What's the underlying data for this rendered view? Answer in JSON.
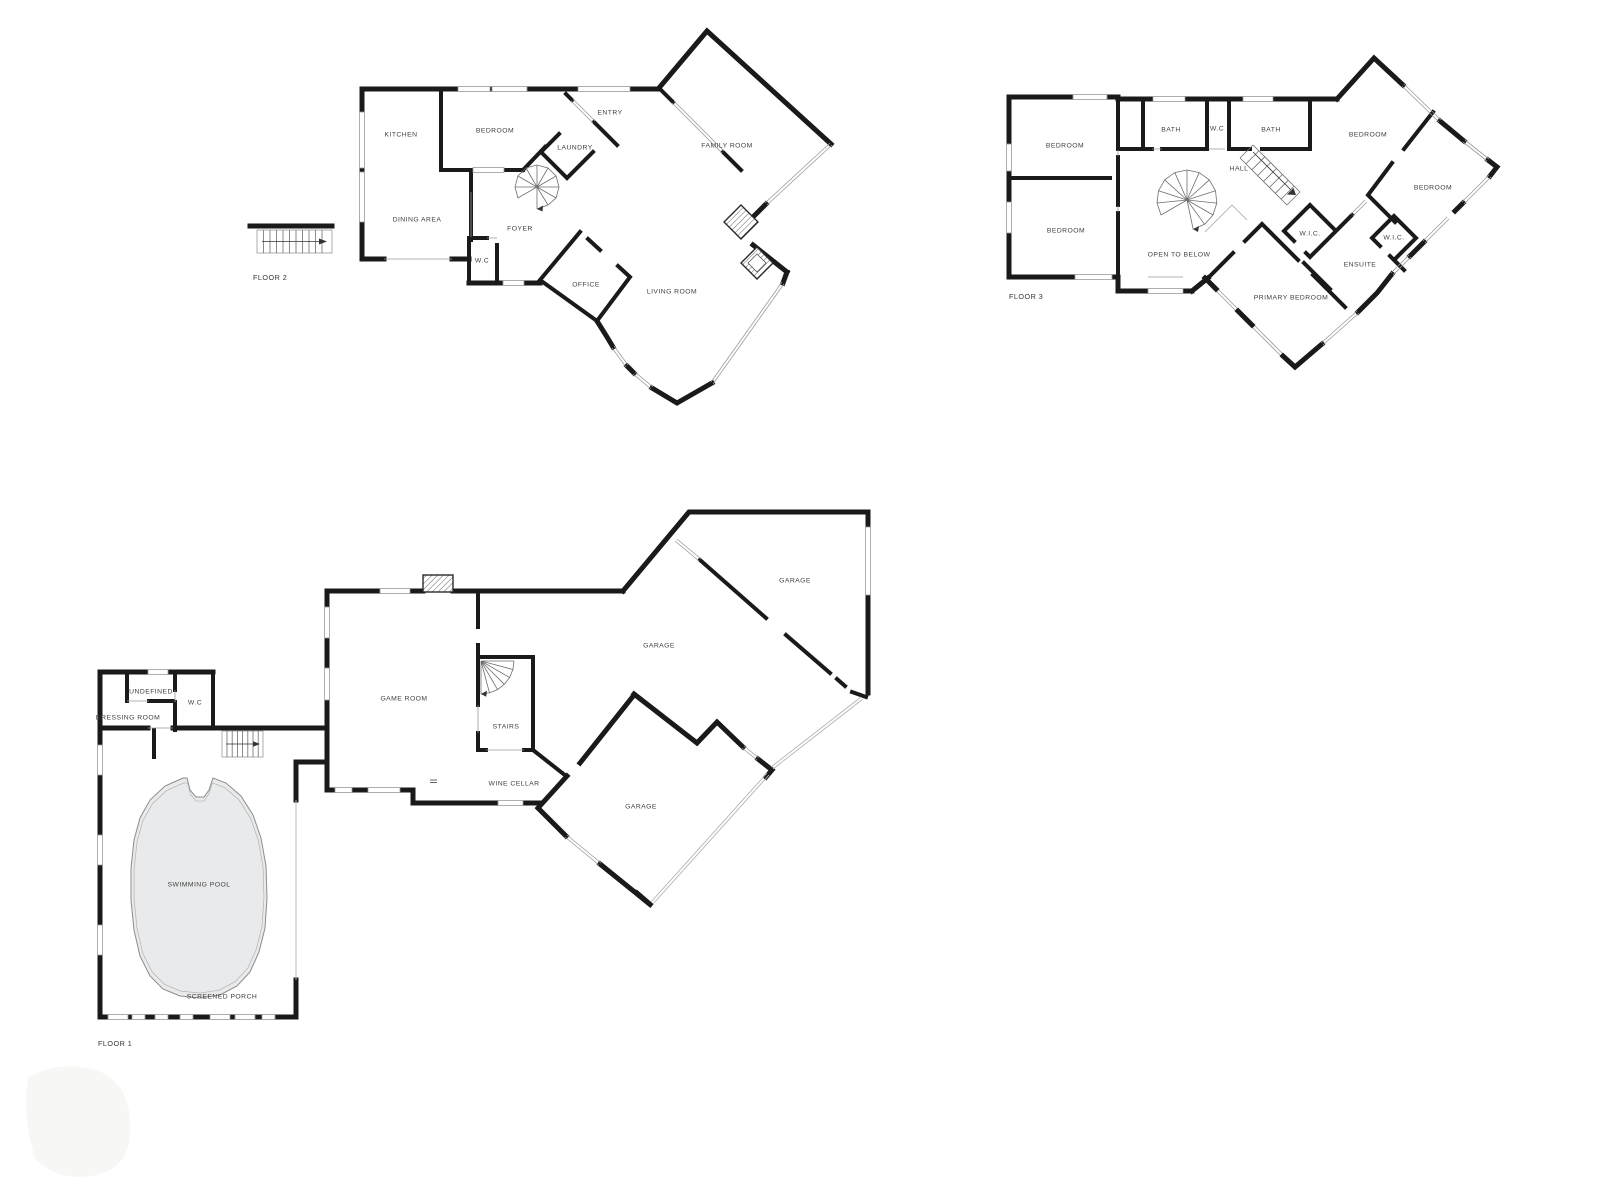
{
  "colors": {
    "ink": "#1a1a1a",
    "win": "#9a9a9a",
    "pool": "#e9eaeb",
    "label": "#3f3f3f",
    "bg": "#ffffff"
  },
  "floor2": {
    "label": "FLOOR 2",
    "rooms": {
      "kitchen": "KITCHEN",
      "bedroom": "BEDROOM",
      "entry": "ENTRY",
      "laundry": "LAUNDRY",
      "family_room": "FAMILY ROOM",
      "dining_area": "DINING AREA",
      "foyer": "FOYER",
      "wc": "W.C",
      "office": "OFFICE",
      "living_room": "LIVING ROOM"
    }
  },
  "floor3": {
    "label": "FLOOR 3",
    "rooms": {
      "bedroom_nw": "BEDROOM",
      "bath_left": "BATH",
      "wc": "W.C",
      "bath_right": "BATH",
      "bedroom_ne": "BEDROOM",
      "hall": "HALL",
      "bedroom_e": "BEDROOM",
      "bedroom_sw": "BEDROOM",
      "open_to_below": "OPEN TO BELOW",
      "wic_left": "W.I.C.",
      "wic_right": "W.I.C.",
      "ensuite": "ENSUITE",
      "primary_bedroom": "PRIMARY BEDROOM"
    }
  },
  "floor1": {
    "label": "FLOOR 1",
    "rooms": {
      "undefined_room": "UNDEFINED",
      "wc": "W.C",
      "dressing_room": "DRESSING ROOM",
      "game_room": "GAME ROOM",
      "stairs": "STAIRS",
      "wine_cellar": "WINE CELLAR",
      "garage_ne": "GARAGE",
      "garage_center": "GARAGE",
      "garage_s": "GARAGE",
      "swimming_pool": "SWIMMING POOL",
      "screened_porch": "SCREENED PORCH"
    }
  }
}
